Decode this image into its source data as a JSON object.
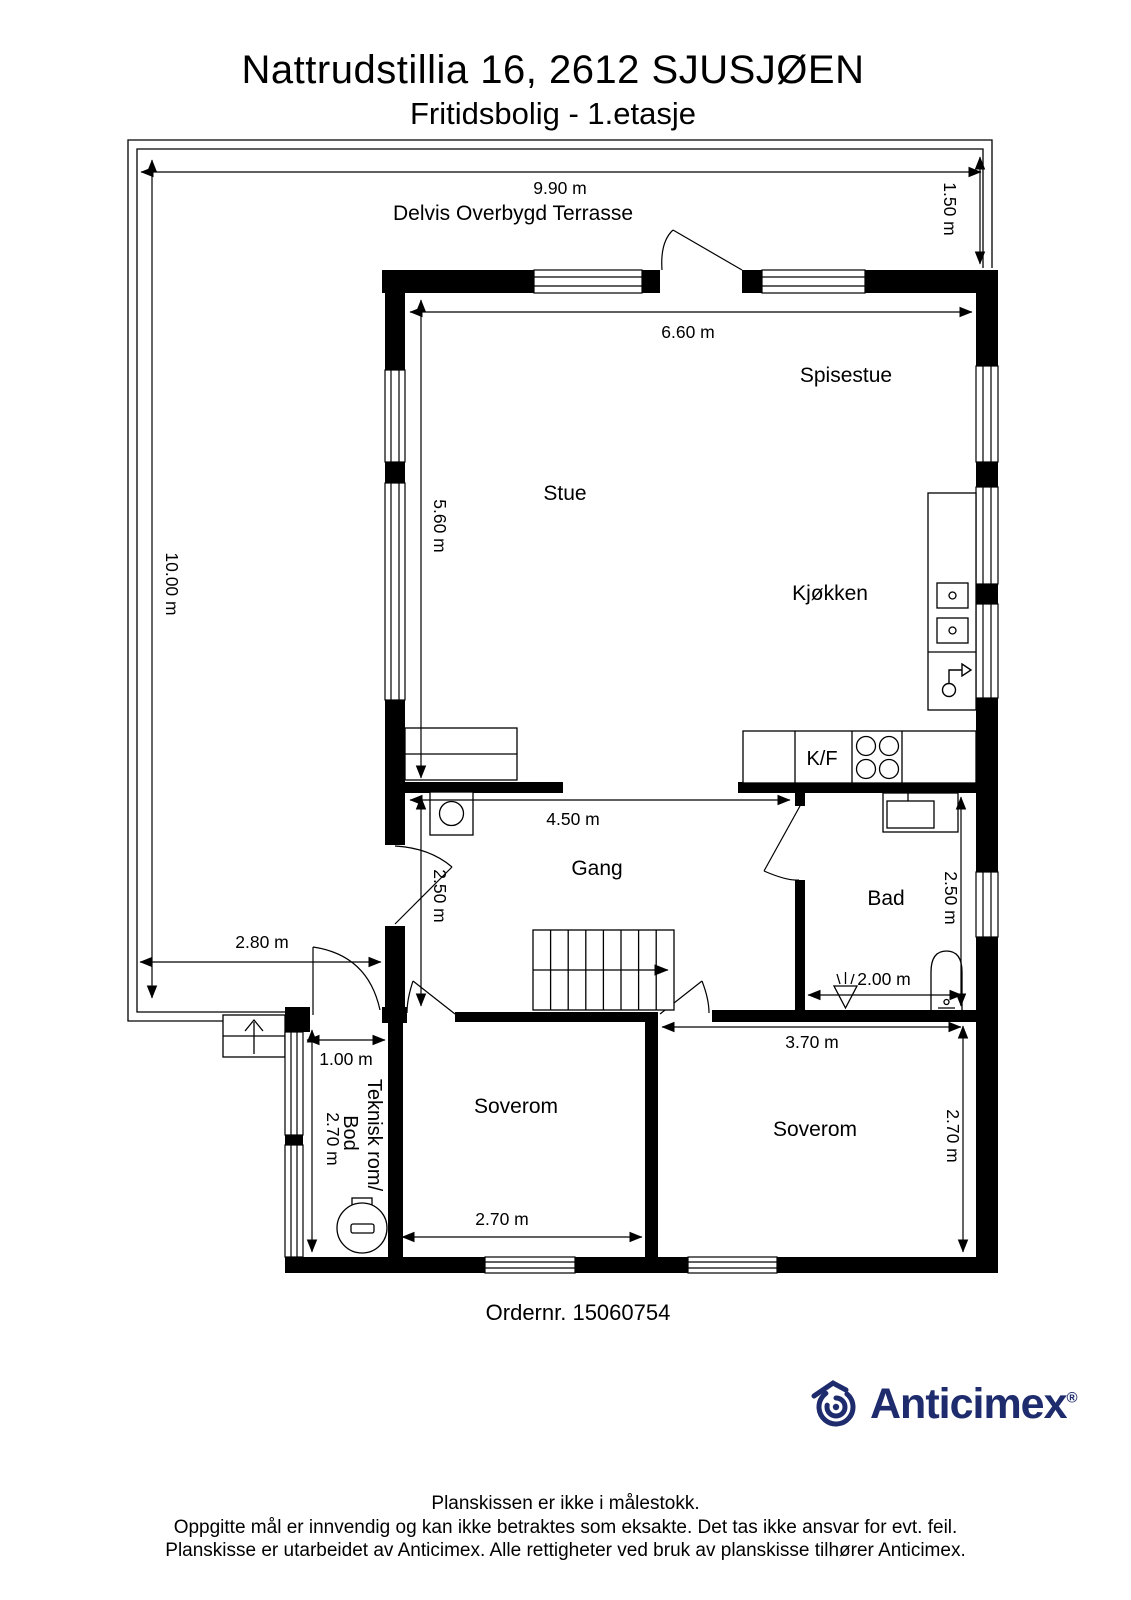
{
  "header": {
    "title": "Nattrudstillia 16, 2612 SJUSJØEN",
    "subtitle": "Fritidsbolig - 1.etasje"
  },
  "plan": {
    "terrace_label": "Delvis Overbygd Terrasse",
    "rooms": {
      "stue": "Stue",
      "spisestue": "Spisestue",
      "kjokken": "Kjøkken",
      "gang": "Gang",
      "bad": "Bad",
      "soverom_left": "Soverom",
      "soverom_right": "Soverom",
      "teknisk_line1": "Teknisk rom/",
      "teknisk_line2": "Bod",
      "kf": "K/F"
    },
    "dimensions": {
      "terrace_width": "9.90 m",
      "terrace_right_depth": "1.50 m",
      "terrace_height": "10.00 m",
      "living_width": "6.60 m",
      "living_height": "5.60 m",
      "gang_width": "4.50 m",
      "gang_height": "2.50 m",
      "terrace_bottom_width": "2.80 m",
      "bad_height": "2.50 m",
      "bad_width": "2.00 m",
      "teknisk_width": "1.00 m",
      "teknisk_height": "2.70 m",
      "soverom_right_width": "3.70 m",
      "soverom_right_height": "2.70 m",
      "soverom_left_width": "2.70 m"
    }
  },
  "order": {
    "text": "Ordernr. 15060754"
  },
  "logo": {
    "brand": "Anticimex",
    "registered": "®",
    "color": "#1e2b6d"
  },
  "footer": {
    "line1": "Planskissen er ikke i målestokk.",
    "line2": "Oppgitte mål er innvendig og kan ikke betraktes som eksakte. Det tas ikke ansvar for evt. feil.",
    "line3": "Planskisse er utarbeidet av Anticimex. Alle rettigheter ved bruk av planskisse tilhører Anticimex."
  }
}
